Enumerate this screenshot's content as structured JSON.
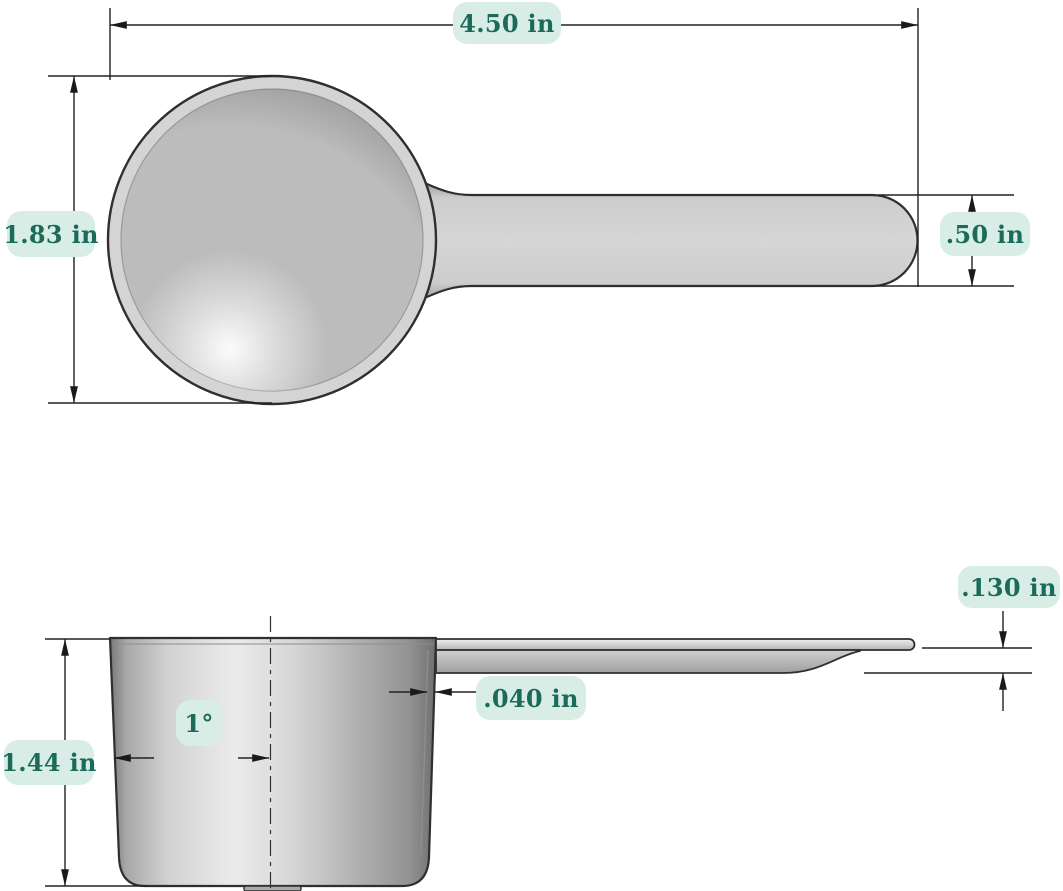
{
  "drawing": {
    "type": "technical-dimension-drawing",
    "units": "in",
    "top_view": {
      "overall_length": "4.50 in",
      "bowl_diameter": "1.83 in",
      "handle_width": ".50 in"
    },
    "side_view": {
      "handle_thickness": ".130 in",
      "wall_thickness": ".040 in",
      "cup_height": "1.44 in",
      "draft_angle": "1°"
    },
    "colors": {
      "background": "#ffffff",
      "label_bg": "#d9ede7",
      "label_text": "#1b6b5b",
      "outline": "#2f2f2f",
      "dimension_line": "#222222",
      "metal_light": "#ebebeb",
      "metal_mid": "#c2c2c2",
      "metal_dark": "#8a8a8a"
    }
  }
}
